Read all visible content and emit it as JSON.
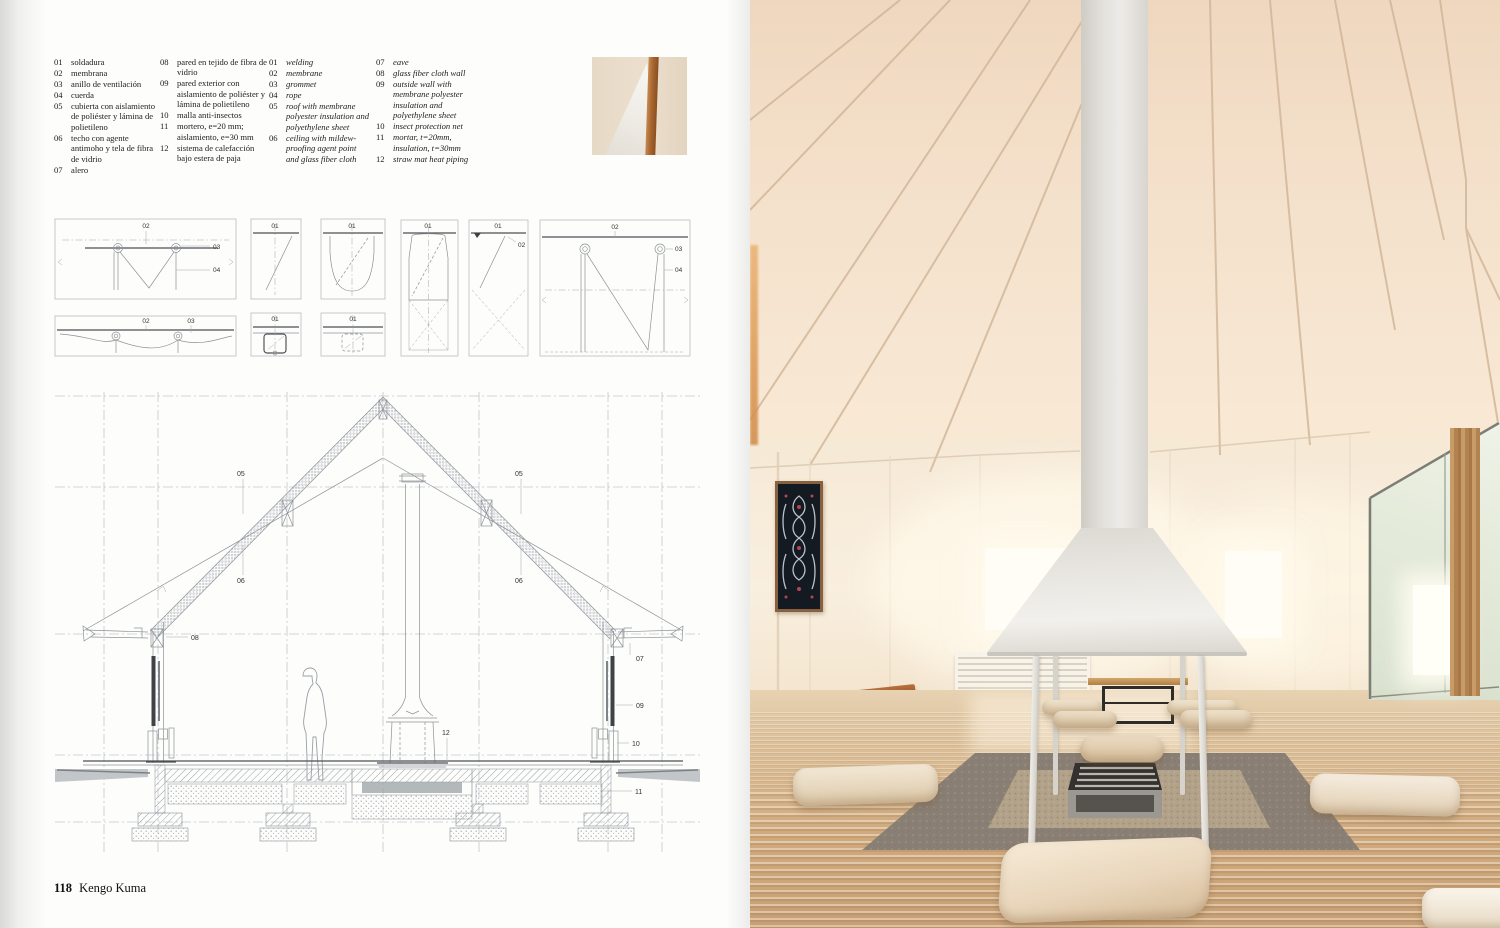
{
  "palette": {
    "drawing_line": "#8d9296",
    "photo_ceiling": "#f3ddc6",
    "photo_floor": "#c9a67c",
    "hearth_gray": "#8a7f74",
    "wood_accent": "#a9662f"
  },
  "page": {
    "number": "118",
    "author": "Kengo Kuma"
  },
  "legend": {
    "es1": [
      {
        "num": "01",
        "text": "soldadura"
      },
      {
        "num": "02",
        "text": "membrana"
      },
      {
        "num": "03",
        "text": "anillo de ventilación"
      },
      {
        "num": "04",
        "text": "cuerda"
      },
      {
        "num": "05",
        "text": "cubierta con aislamiento de poliéster y lámina de polietileno"
      },
      {
        "num": "06",
        "text": "techo con agente antimoho y tela de fibra de vidrio"
      },
      {
        "num": "07",
        "text": "alero"
      }
    ],
    "es2": [
      {
        "num": "08",
        "text": "pared en tejido de fibra de vidrio"
      },
      {
        "num": "09",
        "text": "pared exterior con aislamiento de poliéster y lámina de polietileno"
      },
      {
        "num": "10",
        "text": "malla anti-insectos"
      },
      {
        "num": "11",
        "text": "mortero, e=20 mm; aislamiento, e=30 mm"
      },
      {
        "num": "12",
        "text": "sistema de calefacción bajo estera de paja"
      }
    ],
    "en1": [
      {
        "num": "01",
        "text": "welding"
      },
      {
        "num": "02",
        "text": "membrane"
      },
      {
        "num": "03",
        "text": "grommet"
      },
      {
        "num": "04",
        "text": "rope"
      },
      {
        "num": "05",
        "text": "roof with membrane polyester insulation and polyethylene sheet"
      },
      {
        "num": "06",
        "text": "ceiling with mildew-proofing agent point and glass fiber cloth"
      }
    ],
    "en2": [
      {
        "num": "07",
        "text": "eave"
      },
      {
        "num": "08",
        "text": "glass fiber cloth wall"
      },
      {
        "num": "09",
        "text": "outside wall with membrane polyester insulation and polyethylene sheet"
      },
      {
        "num": "10",
        "text": "insect protection net"
      },
      {
        "num": "11",
        "text": "mortar, t=20mm, insulation, t=30mm"
      },
      {
        "num": "12",
        "text": "straw mat heat piping"
      }
    ]
  },
  "labels": {
    "n01": "01",
    "n02": "02",
    "n03": "03",
    "n04": "04",
    "n05": "05",
    "n06": "06",
    "n07": "07",
    "n08": "08",
    "n09": "09",
    "n10": "10",
    "n11": "11",
    "n12": "12"
  }
}
